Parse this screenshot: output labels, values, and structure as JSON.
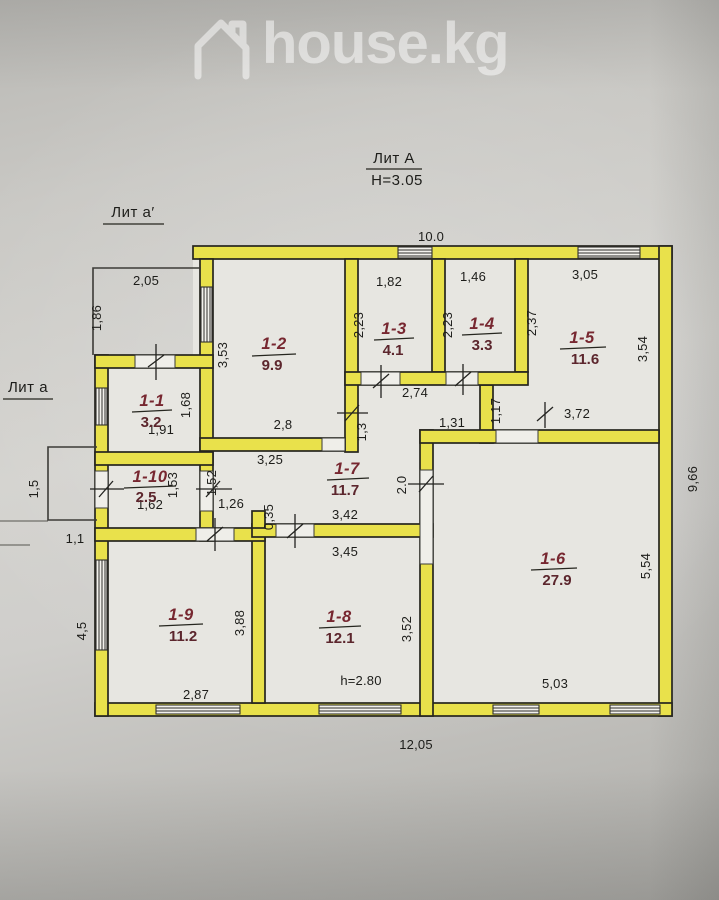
{
  "watermark": {
    "brand": "house.kg"
  },
  "plan": {
    "building_label": "Лит А",
    "building_height": "Н=3.05",
    "annex_top_label": "Лит а′",
    "annex_left_label": "Лит а",
    "rooms": [
      {
        "number": "1-1",
        "area": "3.2"
      },
      {
        "number": "1-2",
        "area": "9.9"
      },
      {
        "number": "1-3",
        "area": "4.1"
      },
      {
        "number": "1-4",
        "area": "3.3"
      },
      {
        "number": "1-5",
        "area": "11.6"
      },
      {
        "number": "1-6",
        "area": "27.9"
      },
      {
        "number": "1-7",
        "area": "11.7"
      },
      {
        "number": "1-8",
        "area": "12.1"
      },
      {
        "number": "1-9",
        "area": "11.2"
      },
      {
        "number": "1-10",
        "area": "2.5"
      }
    ],
    "dims": [
      "10.0",
      "2,05",
      "1,86",
      "1,82",
      "1,46",
      "3,05",
      "2,23",
      "2,23",
      "2,37",
      "3,54",
      "3,53",
      "1,68",
      "1,91",
      "2,8",
      "2,74",
      "1,3",
      "1,31",
      "1,17",
      "3,72",
      "3,25",
      "1,53",
      "1,52",
      "1,62",
      "1,26",
      "0,35",
      "2.0",
      "3,42",
      "3,45",
      "1,5",
      "1,1",
      "4,5",
      "3,88",
      "3,52",
      "5,54",
      "9,66",
      "2,87",
      "h=2.80",
      "5,03",
      "12,05"
    ]
  },
  "colors": {
    "wall_yellow": "#e9e14b",
    "room_label_red": "#772730",
    "paper": "#cfcecb"
  }
}
